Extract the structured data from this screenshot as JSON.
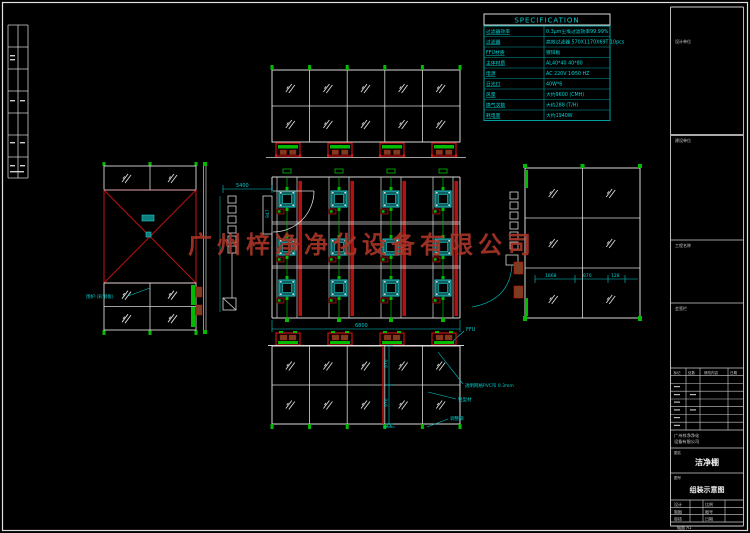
{
  "colors": {
    "background": "#000000",
    "line_white": "#d8d8d8",
    "accent_cyan": "#00cccc",
    "wall_red": "#bb1111",
    "frame_green": "#00bb00",
    "ffu_teal": "#0d6060",
    "wood_brown": "#7a3d20",
    "watermark_red": "#a83528"
  },
  "watermark": {
    "text": "广州梓净净化设备有限公司"
  },
  "spec_table": {
    "title": "SPECIFICATION",
    "rows": [
      {
        "label": "过滤器效率",
        "value": "0.3μm尘埃过滤效率99.99%"
      },
      {
        "label": "过滤器",
        "value": "高效过滤器 570X1170X69T 10pcs"
      },
      {
        "label": "FFU材质",
        "value": "镀锌板"
      },
      {
        "label": "主体材质",
        "value": "AL40*40 40*80"
      },
      {
        "label": "电源",
        "value": "AC 220V 1Φ50 HZ"
      },
      {
        "label": "日光灯",
        "value": "40W*6"
      },
      {
        "label": "风量",
        "value": "大约9600 (CMH)"
      },
      {
        "label": "换气次数",
        "value": "大约288 (T/H)"
      },
      {
        "label": "耗电量",
        "value": "大约1940W"
      }
    ]
  },
  "plan": {
    "dim_top": "5400",
    "dim_door": "947",
    "dim_bottom": "6800",
    "ffu_label": "FFU"
  },
  "right_elevation": {
    "dims": [
      "1868",
      "870",
      "128"
    ]
  },
  "front_elevation": {
    "dims": [
      "970",
      "970"
    ]
  },
  "annotations": {
    "wall_label": "围护:(彩钢板)",
    "curtain_label": "透明网格PVC帘 0.3mm",
    "profile_label": "铝型材",
    "foot_label": "调整脚"
  },
  "title_block": {
    "cells": [
      "设计单位",
      "建设单位",
      "工程名称",
      "会签栏"
    ],
    "company_lines": [
      "广州梓净净化",
      "设备有限公司"
    ],
    "name_label": "图名",
    "drawing_name": "洁净棚",
    "number_label": "图号",
    "drawing_title": "组装示意图",
    "rev_headers": [
      "标记",
      "处数",
      "修改内容",
      "日期"
    ],
    "info_rows": [
      [
        "设计",
        "比例"
      ],
      [
        "制图",
        "图号"
      ],
      [
        "审核",
        "日期"
      ]
    ],
    "sheet_note": "幅面 A1"
  }
}
